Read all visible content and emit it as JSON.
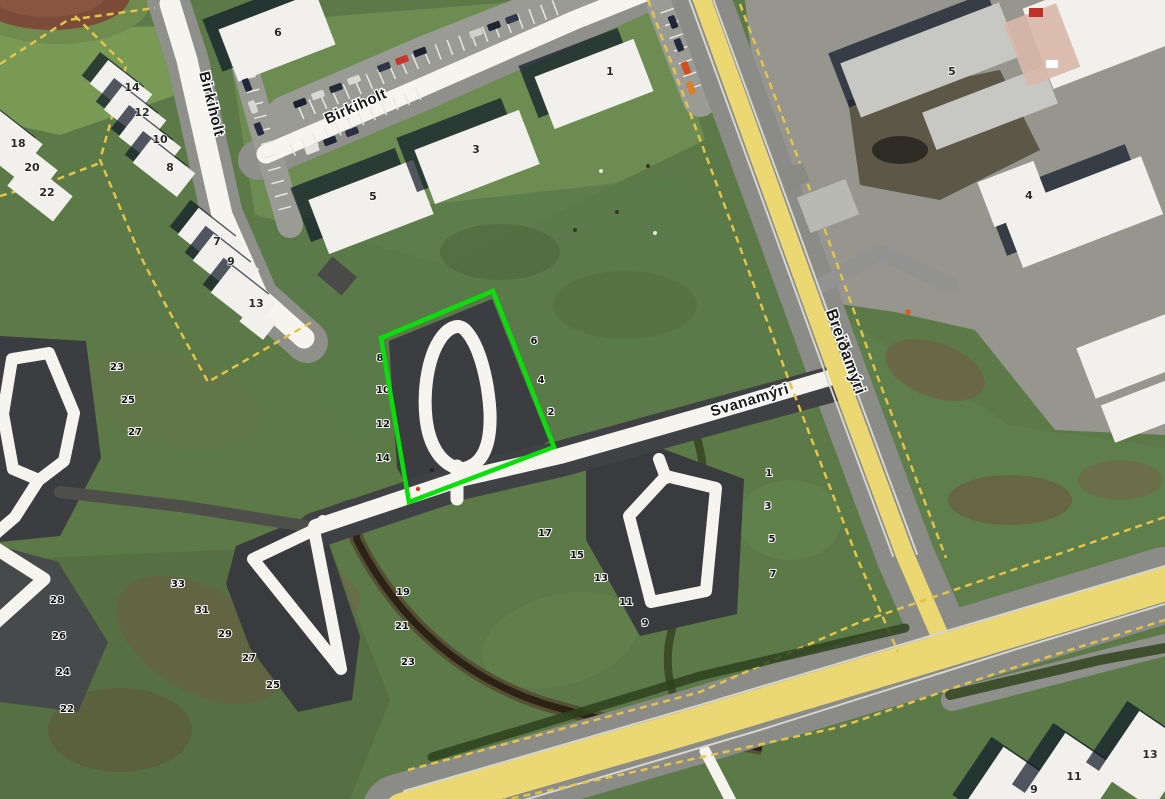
{
  "map": {
    "type": "aerial-satellite-map",
    "highlight_plot": {
      "points": "381,338 493,291 554,447 409,502",
      "color": "#0cdd0c"
    },
    "road_yellow": "#ebd873",
    "streets": [
      {
        "name": "Birkiholt",
        "x": 211,
        "y": 104,
        "rotation": 76,
        "size": 15
      },
      {
        "name": "Birkiholt",
        "x": 356,
        "y": 107,
        "rotation": -24,
        "size": 15
      },
      {
        "name": "Svanamýri",
        "x": 750,
        "y": 401,
        "rotation": -17,
        "size": 15
      },
      {
        "name": "Breiðamýri",
        "x": 845,
        "y": 352,
        "rotation": 70,
        "size": 16
      }
    ],
    "plot_numbers": [
      {
        "n": "23",
        "x": 117,
        "y": 367
      },
      {
        "n": "25",
        "x": 128,
        "y": 400
      },
      {
        "n": "27",
        "x": 135,
        "y": 432
      },
      {
        "n": "28",
        "x": 57,
        "y": 600
      },
      {
        "n": "26",
        "x": 59,
        "y": 636
      },
      {
        "n": "24",
        "x": 63,
        "y": 672
      },
      {
        "n": "22",
        "x": 67,
        "y": 709
      },
      {
        "n": "33",
        "x": 178,
        "y": 584
      },
      {
        "n": "31",
        "x": 202,
        "y": 610
      },
      {
        "n": "29",
        "x": 225,
        "y": 634
      },
      {
        "n": "27",
        "x": 249,
        "y": 658
      },
      {
        "n": "25",
        "x": 273,
        "y": 685
      },
      {
        "n": "19",
        "x": 403,
        "y": 592
      },
      {
        "n": "21",
        "x": 402,
        "y": 626
      },
      {
        "n": "23",
        "x": 408,
        "y": 662
      },
      {
        "n": "17",
        "x": 545,
        "y": 533
      },
      {
        "n": "15",
        "x": 577,
        "y": 555
      },
      {
        "n": "13",
        "x": 601,
        "y": 578
      },
      {
        "n": "11",
        "x": 626,
        "y": 602
      },
      {
        "n": "9",
        "x": 645,
        "y": 623
      },
      {
        "n": "8",
        "x": 380,
        "y": 358
      },
      {
        "n": "10",
        "x": 383,
        "y": 390
      },
      {
        "n": "12",
        "x": 383,
        "y": 424
      },
      {
        "n": "14",
        "x": 383,
        "y": 458
      },
      {
        "n": "6",
        "x": 534,
        "y": 341
      },
      {
        "n": "4",
        "x": 541,
        "y": 380
      },
      {
        "n": "2",
        "x": 551,
        "y": 412
      },
      {
        "n": "1",
        "x": 769,
        "y": 473
      },
      {
        "n": "3",
        "x": 768,
        "y": 506
      },
      {
        "n": "5",
        "x": 772,
        "y": 539
      },
      {
        "n": "7",
        "x": 773,
        "y": 574
      }
    ],
    "building_numbers": [
      {
        "n": "6",
        "x": 278,
        "y": 33
      },
      {
        "n": "1",
        "x": 610,
        "y": 72
      },
      {
        "n": "3",
        "x": 476,
        "y": 150
      },
      {
        "n": "5",
        "x": 373,
        "y": 197
      },
      {
        "n": "14",
        "x": 132,
        "y": 88
      },
      {
        "n": "12",
        "x": 142,
        "y": 113
      },
      {
        "n": "10",
        "x": 160,
        "y": 140
      },
      {
        "n": "8",
        "x": 170,
        "y": 168
      },
      {
        "n": "18",
        "x": 18,
        "y": 144
      },
      {
        "n": "20",
        "x": 32,
        "y": 168
      },
      {
        "n": "22",
        "x": 47,
        "y": 193
      },
      {
        "n": "7",
        "x": 217,
        "y": 242
      },
      {
        "n": "9",
        "x": 231,
        "y": 262
      },
      {
        "n": "13",
        "x": 256,
        "y": 304
      },
      {
        "n": "5",
        "x": 952,
        "y": 72
      },
      {
        "n": "4",
        "x": 1029,
        "y": 196
      },
      {
        "n": "9",
        "x": 1034,
        "y": 790
      },
      {
        "n": "11",
        "x": 1074,
        "y": 777
      },
      {
        "n": "13",
        "x": 1150,
        "y": 755
      }
    ]
  }
}
